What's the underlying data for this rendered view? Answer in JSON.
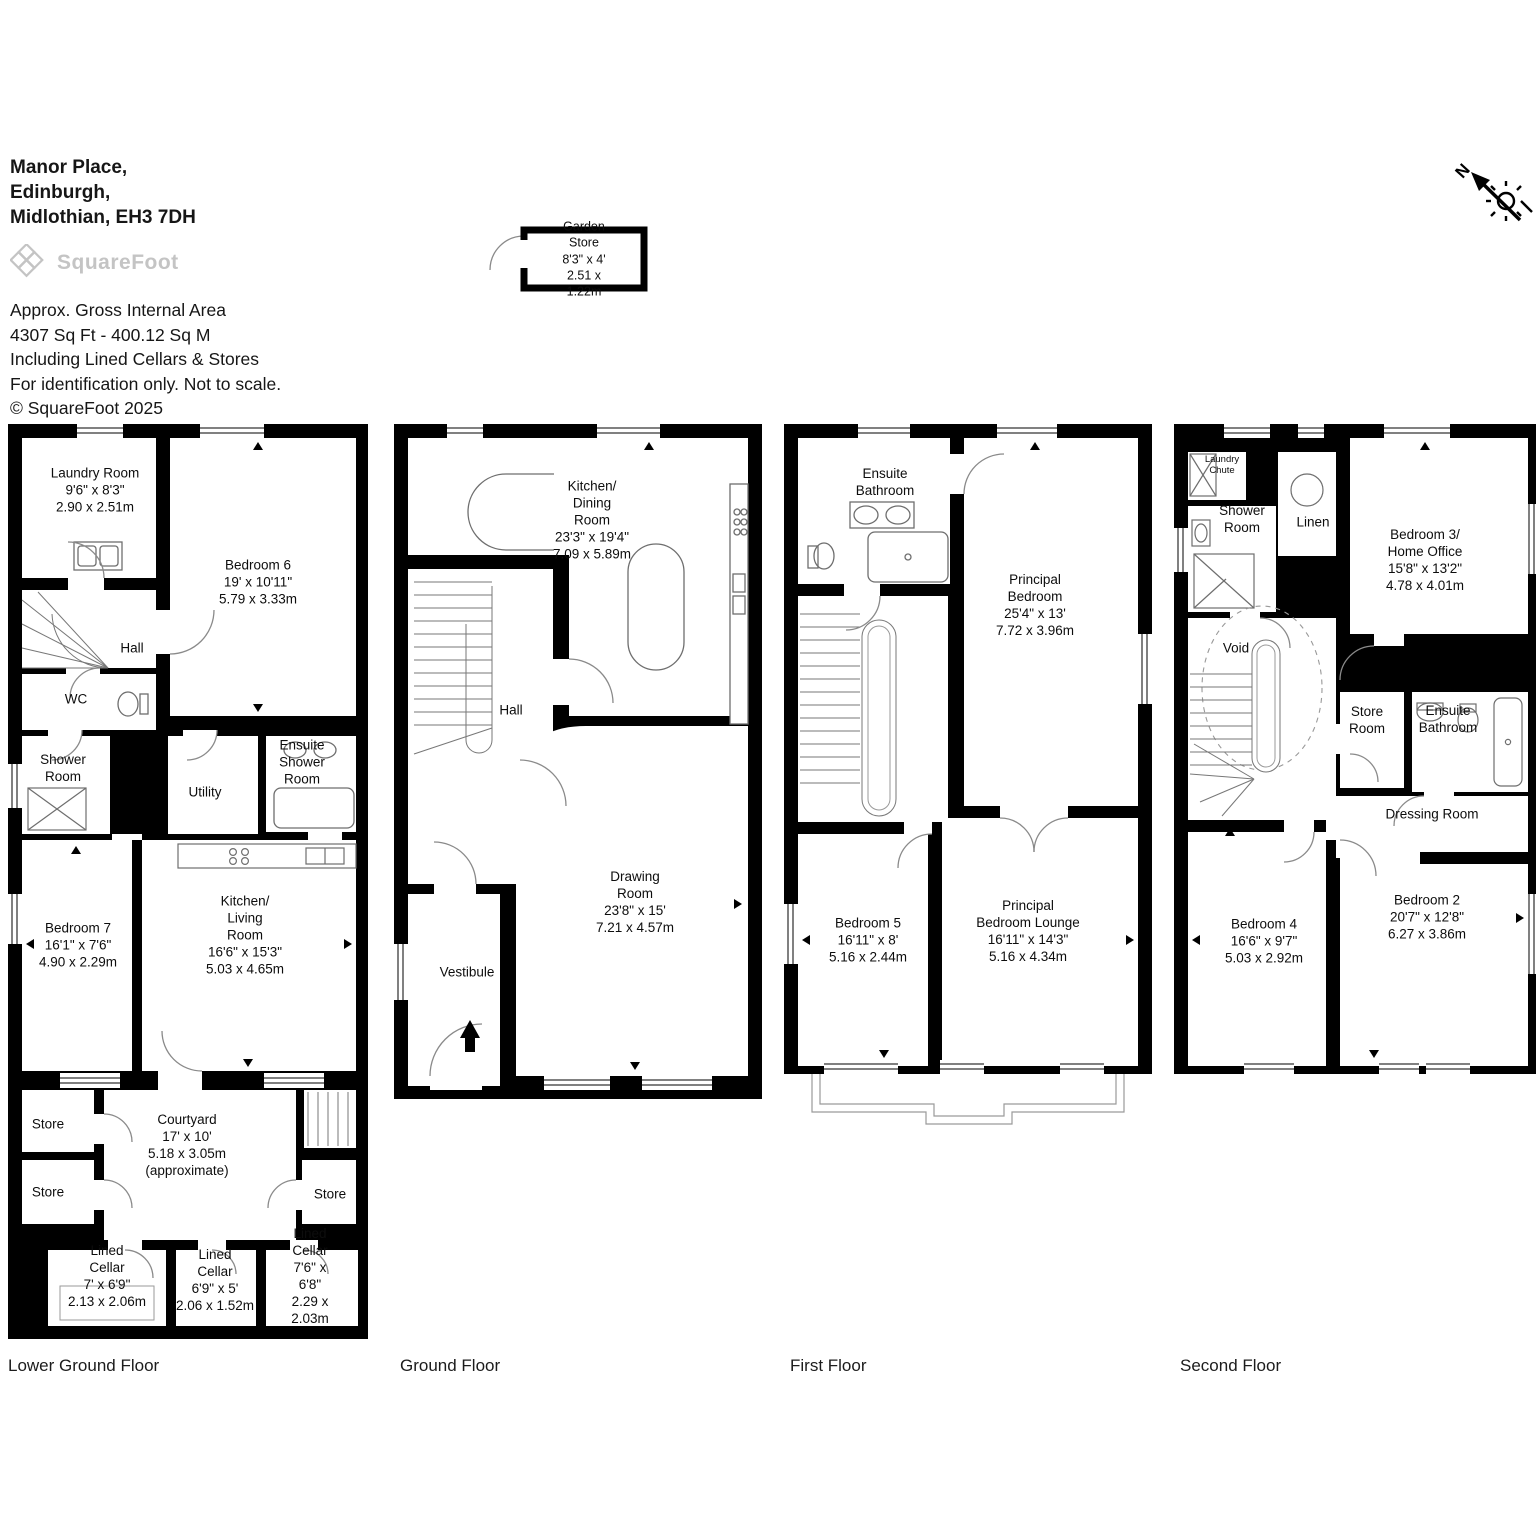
{
  "header": {
    "address": [
      "Manor Place,",
      "Edinburgh,",
      "Midlothian, EH3 7DH"
    ],
    "logo": "SquareFoot",
    "area_lines": [
      "Approx. Gross Internal Area",
      "4307 Sq Ft  - 400.12 Sq M",
      "Including Lined Cellars & Stores",
      "For identification only. Not to scale.",
      "© SquareFoot 2025"
    ]
  },
  "compass": {
    "n": "N"
  },
  "garden_store": {
    "label": "Garden Store\n8'3\" x 4'\n2.51 x 1.22m"
  },
  "colors": {
    "wall": "#000000",
    "fixture_line": "#6e6e6e",
    "door_line": "#8a8a8a",
    "balcony_line": "#9a9a9a"
  },
  "floors": {
    "lower_ground": {
      "name": "Lower Ground Floor",
      "rooms": {
        "laundry": "Laundry Room\n9'6\" x 8'3\"\n2.90 x 2.51m",
        "bedroom6": "Bedroom 6\n19' x 10'11\"\n5.79 x 3.33m",
        "hall": "Hall",
        "wc": "WC",
        "shower": "Shower\nRoom",
        "utility": "Utility",
        "ensuite_shower": "Ensuite\nShower\nRoom",
        "bedroom7": "Bedroom 7\n16'1\" x 7'6\"\n4.90 x 2.29m",
        "kitchen_living": "Kitchen/\nLiving\nRoom\n16'6\" x 15'3\"\n5.03 x 4.65m",
        "store1": "Store",
        "store2": "Store",
        "store3": "Store",
        "courtyard": "Courtyard\n17' x 10'\n5.18 x 3.05m\n(approximate)",
        "cellar1": "Lined\nCellar\n7' x 6'9\"\n2.13 x 2.06m",
        "cellar2": "Lined\nCellar\n6'9\" x 5'\n2.06 x 1.52m",
        "cellar3": "Lined\nCellar\n7'6\" x 6'8\"\n2.29 x 2.03m"
      }
    },
    "ground": {
      "name": "Ground Floor",
      "rooms": {
        "kitchen_dining": "Kitchen/\nDining\nRoom\n23'3\" x 19'4\"\n7.09 x 5.89m",
        "hall": "Hall",
        "vestibule": "Vestibule",
        "drawing": "Drawing\nRoom\n23'8\" x 15'\n7.21 x 4.57m"
      }
    },
    "first": {
      "name": "First Floor",
      "rooms": {
        "ensuite_bathroom": "Ensuite\nBathroom",
        "principal_bedroom": "Principal\nBedroom\n25'4\" x 13'\n7.72 x 3.96m",
        "bedroom5": "Bedroom 5\n16'11\" x 8'\n5.16 x 2.44m",
        "principal_lounge": "Principal\nBedroom Lounge\n16'11\" x 14'3\"\n5.16 x 4.34m"
      }
    },
    "second": {
      "name": "Second Floor",
      "rooms": {
        "laundry_chute": "Laundry\nChute",
        "shower_room": "Shower\nRoom",
        "linen": "Linen",
        "bedroom3": "Bedroom 3/\nHome Office\n15'8\" x 13'2\"\n4.78 x 4.01m",
        "void": "Void",
        "store_room": "Store\nRoom",
        "ensuite_bathroom": "Ensuite\nBathroom",
        "dressing": "Dressing Room",
        "bedroom4": "Bedroom 4\n16'6\" x 9'7\"\n5.03 x 2.92m",
        "bedroom2": "Bedroom 2\n20'7\" x 12'8\"\n6.27 x 3.86m"
      }
    }
  }
}
